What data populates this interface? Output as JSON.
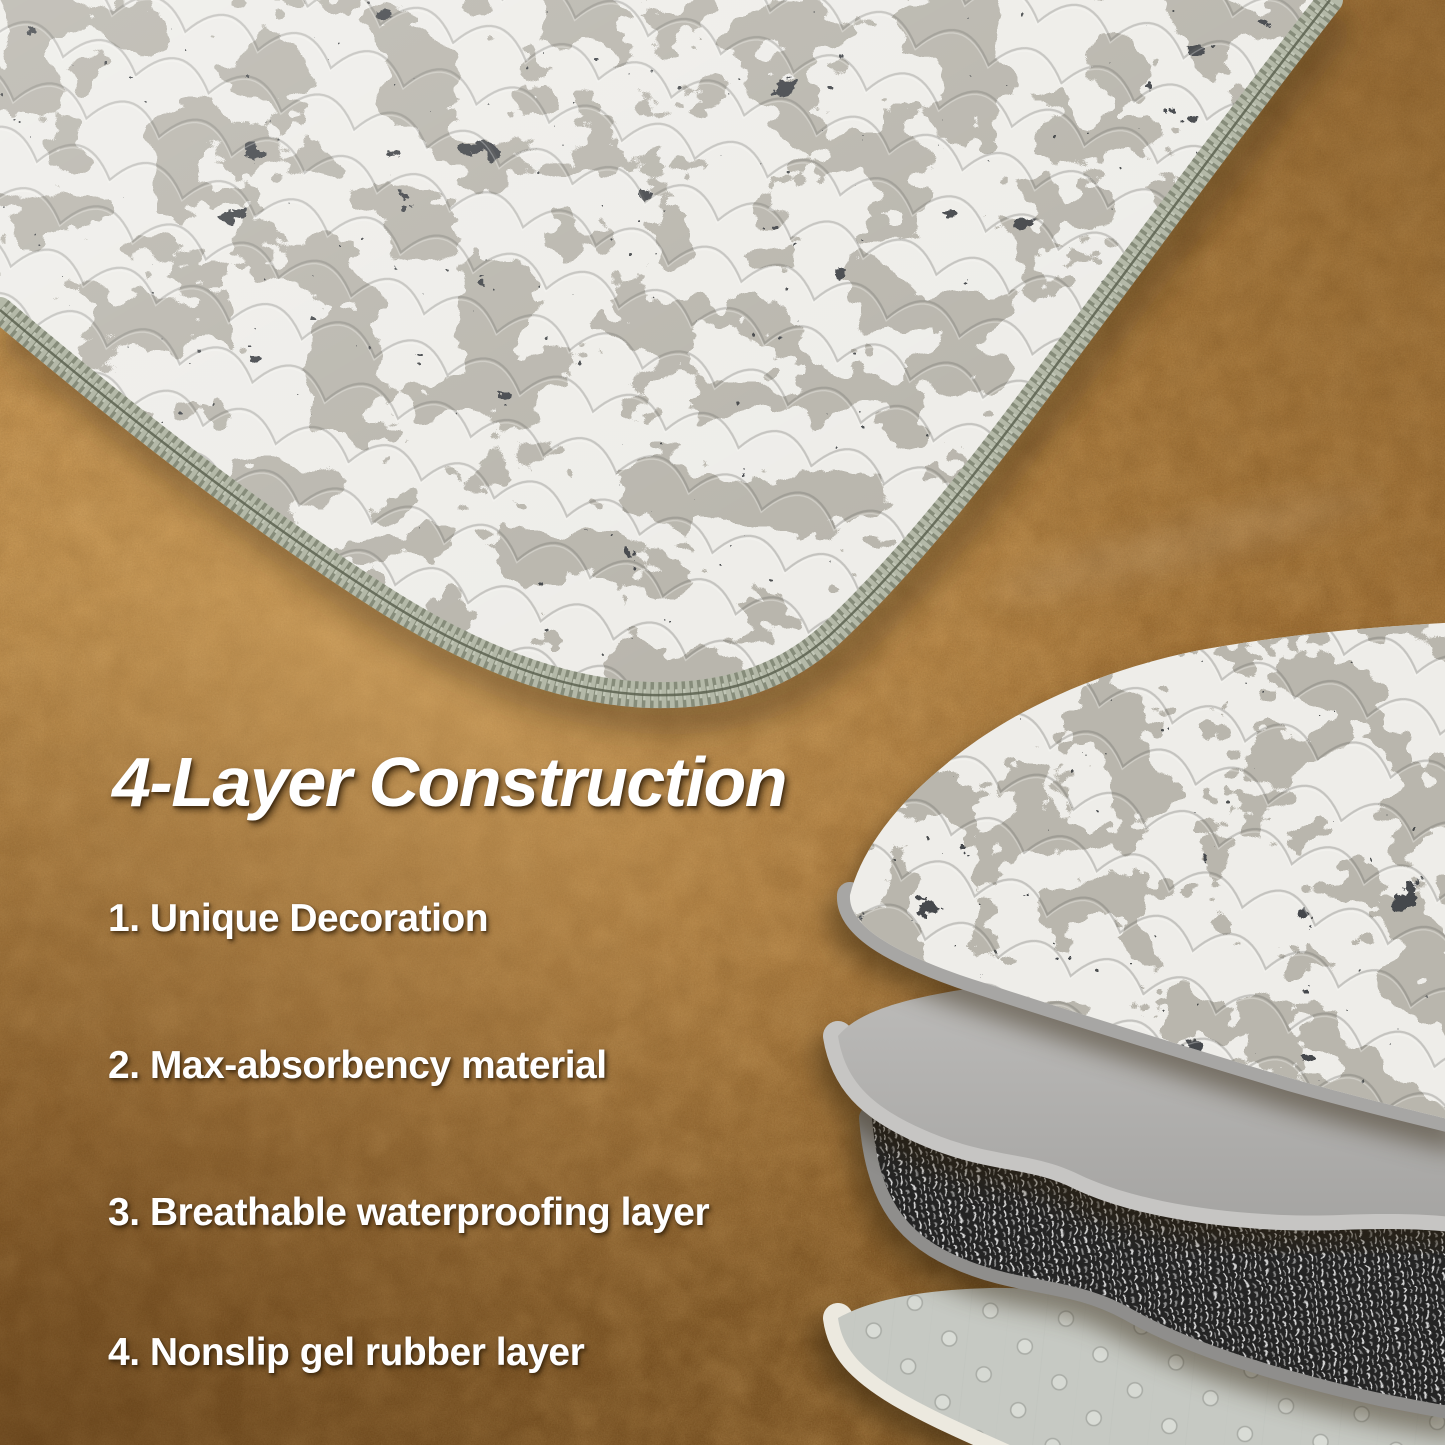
{
  "content": {
    "title": "4-Layer Construction",
    "features": [
      "1. Unique Decoration",
      "2. Max-absorbency material",
      "3. Breathable waterproofing layer",
      "4. Nonslip gel rubber layer"
    ]
  },
  "colors": {
    "floor_base": "#b58443",
    "floor_light": "#d9ad6b",
    "floor_dark": "#7f5726",
    "text": "#ffffff",
    "fabric_light": "#eeede9",
    "fabric_mid": "#b9b6ad",
    "fabric_dark": "#45484c",
    "fabric_speck": "#3a3d40",
    "serge_edge": "#b4b9a8",
    "serge_stitch": "#868c7a",
    "layer1_rim": "#a7a6a4",
    "layer2_gray": "#b2b1af",
    "layer2_rim": "#c6c5c3",
    "layer3_dark": "#242424",
    "layer3_rim": "#8f8e8c",
    "layer4_gray": "#c6c9c3",
    "layer4_rim": "#ece9df"
  }
}
